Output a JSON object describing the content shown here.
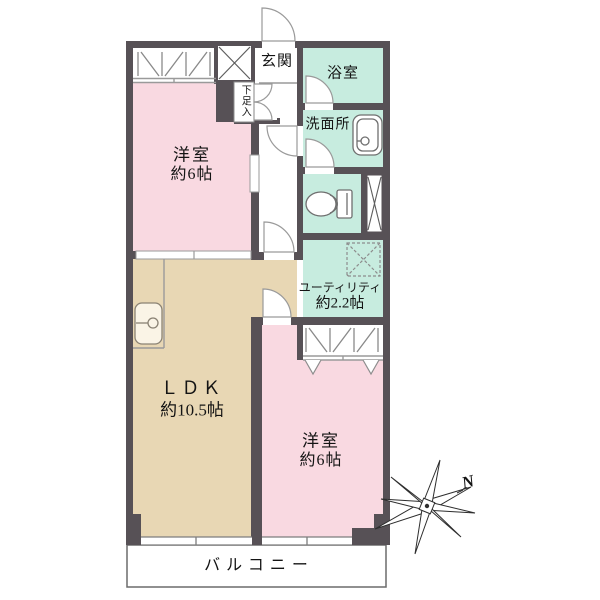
{
  "plan": {
    "rooms": {
      "bedroom_top": {
        "label": "洋室",
        "area": "約6帖"
      },
      "bedroom_bottom": {
        "label": "洋室",
        "area": "約6帖"
      },
      "ldk": {
        "label": "ＬＤＫ",
        "area": "約10.5帖"
      },
      "utility": {
        "label": "ユーティリティ",
        "area": "約2.2帖"
      },
      "bath": {
        "label": "浴室"
      },
      "washroom": {
        "label": "洗面所"
      },
      "entrance": {
        "label": "玄関"
      },
      "shoe_cabinet": {
        "label": "下足入"
      },
      "balcony": {
        "label": "バルコニー"
      }
    },
    "compass": {
      "north_label": "N"
    },
    "colors": {
      "wall": "#575156",
      "bedroom_fill": "#f9d9e1",
      "ldk_fill": "#e8d7b4",
      "wet_area_fill": "#c7ecdf",
      "line": "#9a9a9a"
    }
  }
}
